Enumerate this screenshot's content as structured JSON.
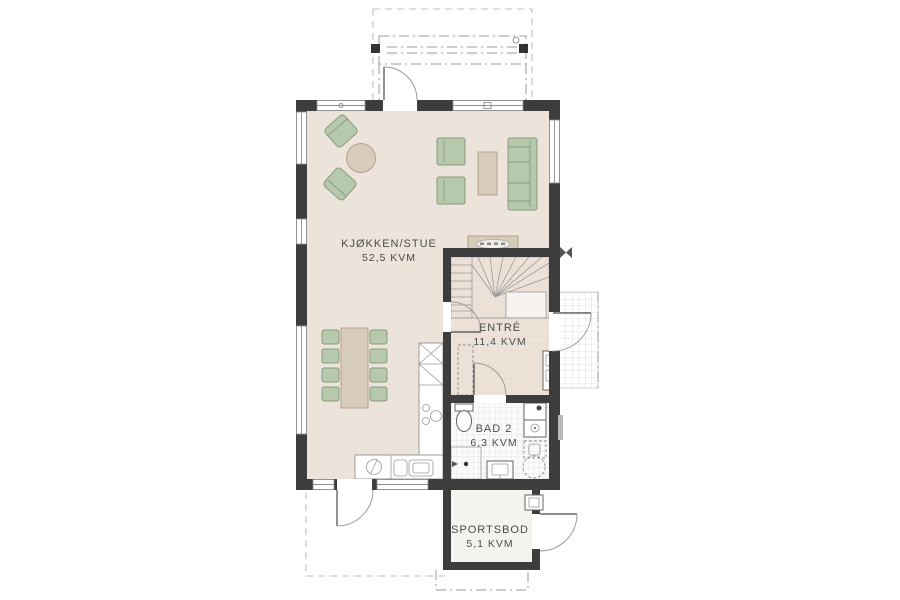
{
  "rooms": [
    {
      "name": "KJØKKEN/STUE",
      "area": "52,5 KVM"
    },
    {
      "name": "ENTRÉ",
      "area": "11,4 KVM"
    },
    {
      "name": "BAD 2",
      "area": "6,3 KVM"
    },
    {
      "name": "SPORTSBOD",
      "area": "5,1 KVM"
    }
  ],
  "colors": {
    "wall": "#3d3d3d",
    "floor_main": "#ece3da",
    "floor_entre": "#ece2d8",
    "floor_bath": "#fbfbf9",
    "floor_storage": "#f3f3f0",
    "furniture_green": "#b7c9ad",
    "furniture_green_border": "#8a9c80",
    "furniture_wood": "#d7cbbc",
    "furniture_wood_border": "#b3a290",
    "label_text": "#4c4c4c"
  }
}
